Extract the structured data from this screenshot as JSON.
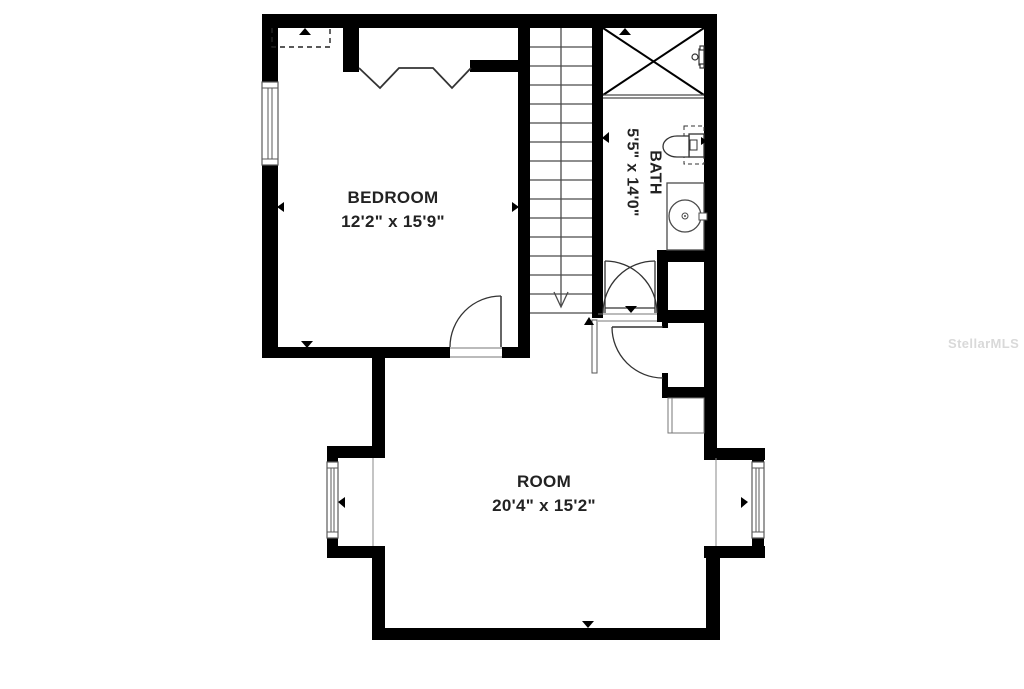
{
  "rooms": {
    "bedroom": {
      "name": "BEDROOM",
      "dims": "12'2\" x 15'9\""
    },
    "bath": {
      "name": "BATH",
      "dims": "5'5\" x 14'0\""
    },
    "room": {
      "name": "ROOM",
      "dims": "20'4\" x 15'2\""
    }
  },
  "watermark": "StellarMLS",
  "colors": {
    "walls": "#000000",
    "thin_lines": "#4a4a4a",
    "background": "#ffffff",
    "watermark_text": "#d9d9d9",
    "label_text": "#222222"
  },
  "icons": {
    "stairs": "stairs-down-arrow-icon",
    "shower": "shower-pan-x-icon",
    "toilet": "toilet-icon",
    "sink": "sink-vanity-icon",
    "windows": "window-icon",
    "doors": "door-swing-icon",
    "closet_doors": "bifold-door-icon",
    "attic": "dashed-outline-icon"
  }
}
